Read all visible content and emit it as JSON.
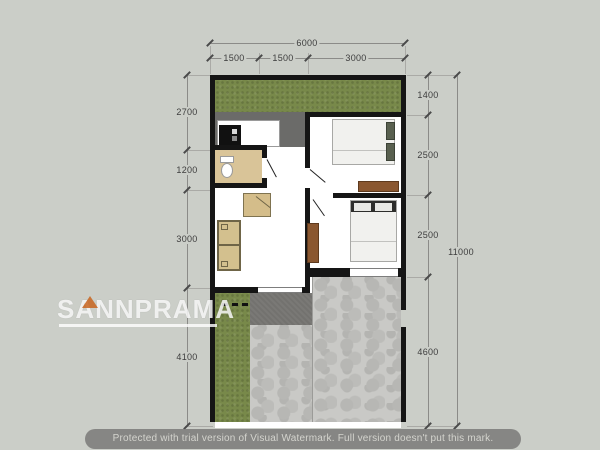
{
  "plan": {
    "dims_top": {
      "total": "6000",
      "segments": [
        "1500",
        "1500",
        "3000"
      ]
    },
    "dims_left": {
      "segments": [
        "2700",
        "1200",
        "3000",
        "4100"
      ]
    },
    "dims_right": {
      "segments": [
        "1400",
        "2500",
        "2500",
        "4600"
      ],
      "total": "11000"
    }
  },
  "watermark": {
    "brand": "SANNPRAMA",
    "notice": "Protected with trial version of Visual Watermark. Full version doesn't put this mark."
  },
  "colors": {
    "background": "#cbcec8",
    "wall": "#151515",
    "grass": "#78894a",
    "stone": "#c9c9c6",
    "concrete": "#73726f",
    "bath_tile": "#d9c498",
    "wood": "#8a5730",
    "accent": "#c8641e"
  }
}
